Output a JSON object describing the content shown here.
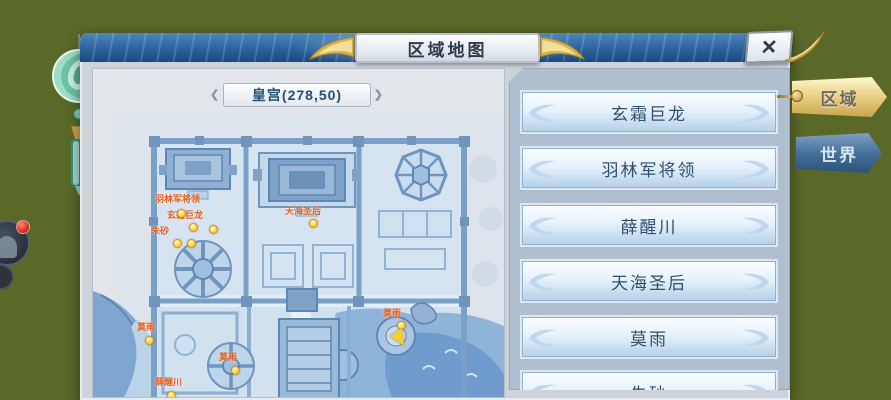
{
  "window": {
    "title": "区域地图",
    "close_glyph": "✕"
  },
  "side_tabs": [
    {
      "label": "区域",
      "active": true
    },
    {
      "label": "世界",
      "active": false
    }
  ],
  "map_panel": {
    "location_label": "皇宫(278,50)",
    "chevron_left": "❮",
    "chevron_right": "❯",
    "markers": [
      {
        "label": "羽林军将领"
      },
      {
        "label": "玄霜巨龙"
      },
      {
        "label": "朱砂"
      },
      {
        "label": "天海圣后"
      },
      {
        "label": "莫雨"
      },
      {
        "label": "莫雨"
      },
      {
        "label": "薛醒川"
      },
      {
        "label": "莫雨"
      }
    ]
  },
  "roster": {
    "items": [
      "玄霜巨龙",
      "羽林军将领",
      "薛醒川",
      "天海圣后",
      "莫雨",
      "朱砂"
    ]
  },
  "colors": {
    "background_olive": "#5a6828",
    "banner_blue": "#2c639b",
    "accent_gold": "#d9b44e",
    "marker_orange": "#e35f1f",
    "marker_yellow": "#ffd23a",
    "map_line_blue": "#7ba0c8"
  }
}
